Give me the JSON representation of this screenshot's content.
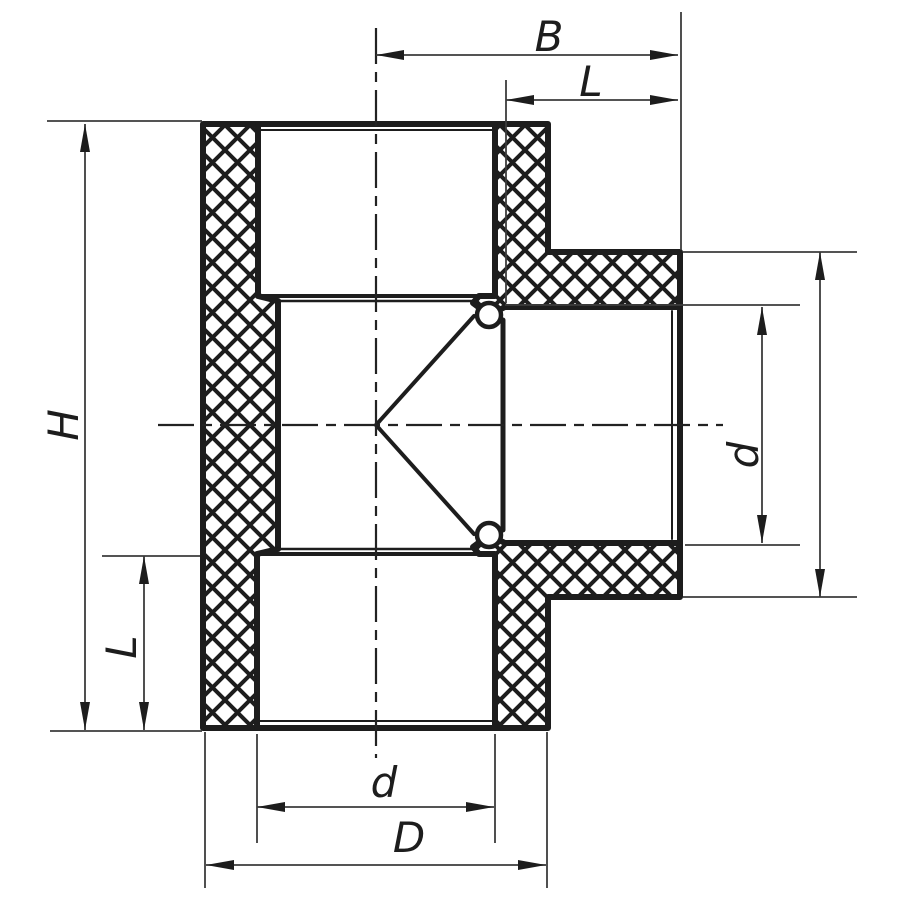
{
  "drawing": {
    "type": "technical-cross-section",
    "subject": "PPR tee pipe fitting section drawing",
    "background_color": "#ffffff",
    "line_color": "#1d1d1d",
    "thin_line_color": "#3c3c3c"
  },
  "dimensions": {
    "width_center_to_branch": {
      "label": "B"
    },
    "branch_socket_depth": {
      "label": "L"
    },
    "overall_height": {
      "label": "H"
    },
    "bottom_socket_depth": {
      "label": "L"
    },
    "branch_bore_diameter": {
      "label": "d"
    },
    "main_bore_diameter": {
      "label": "d"
    },
    "outer_diameter": {
      "label": "D"
    }
  }
}
